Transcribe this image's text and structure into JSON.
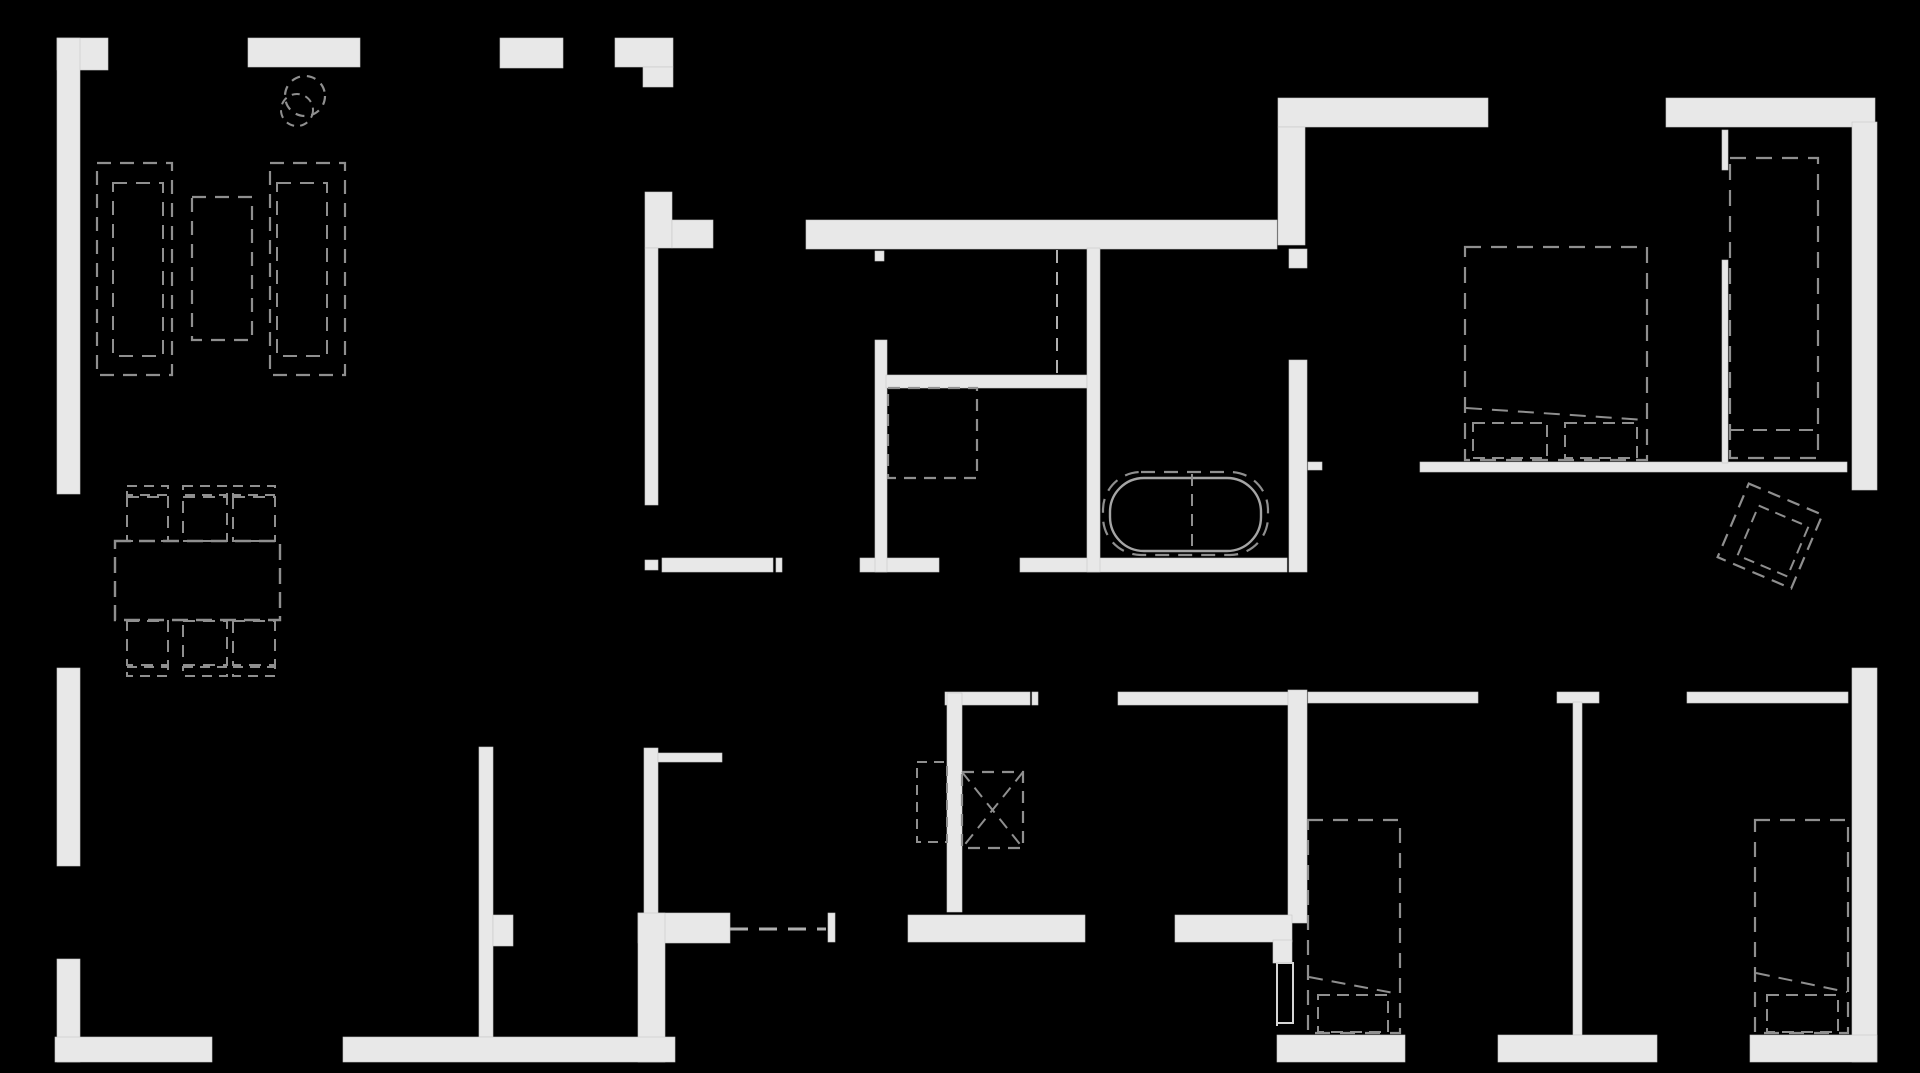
{
  "canvas": {
    "width": 1920,
    "height": 1073,
    "background": "#000000"
  },
  "palette": {
    "wall_fill": "#e8e8e8",
    "wall_edge": "#c6c6c6",
    "furniture_stroke": "#8f8f8f",
    "fixture_stroke": "#a5a5a5",
    "door_stroke": "#b0b0b0",
    "leaf_stroke": "#d6d6d6"
  },
  "walls": [
    {
      "n": "wall-top-left-corner-arm",
      "x": 57,
      "y": 38,
      "w": 51,
      "h": 32
    },
    {
      "n": "wall-left-upper",
      "x": 57,
      "y": 38,
      "w": 23,
      "h": 456
    },
    {
      "n": "wall-left-middle",
      "x": 57,
      "y": 668,
      "w": 23,
      "h": 198
    },
    {
      "n": "wall-left-lower",
      "x": 57,
      "y": 959,
      "w": 23,
      "h": 103
    },
    {
      "n": "wall-bottom-left-corner-arm",
      "x": 55,
      "y": 1037,
      "w": 157,
      "h": 25
    },
    {
      "n": "wall-top-a",
      "x": 248,
      "y": 38,
      "w": 112,
      "h": 29
    },
    {
      "n": "wall-top-b",
      "x": 500,
      "y": 38,
      "w": 63,
      "h": 30
    },
    {
      "n": "wall-top-c",
      "x": 615,
      "y": 38,
      "w": 58,
      "h": 29
    },
    {
      "n": "wall-top-c-step",
      "x": 643,
      "y": 67,
      "w": 30,
      "h": 20
    },
    {
      "n": "wall-corridor-upper-l",
      "x": 645,
      "y": 192,
      "w": 27,
      "h": 56
    },
    {
      "n": "wall-corridor-upper-arm",
      "x": 672,
      "y": 220,
      "w": 41,
      "h": 28
    },
    {
      "n": "wall-corridor-left-upper",
      "x": 645,
      "y": 248,
      "w": 13,
      "h": 257
    },
    {
      "n": "wall-corridor-stub",
      "x": 645,
      "y": 560,
      "w": 13,
      "h": 10
    },
    {
      "n": "wall-mid-bottom-a",
      "x": 662,
      "y": 558,
      "w": 111,
      "h": 14
    },
    {
      "n": "door-tick-mid-a",
      "x": 776,
      "y": 558,
      "w": 6,
      "h": 14
    },
    {
      "n": "wall-mid-bottom-b",
      "x": 860,
      "y": 558,
      "w": 79,
      "h": 14
    },
    {
      "n": "wall-mid-bottom-c",
      "x": 1020,
      "y": 558,
      "w": 267,
      "h": 14
    },
    {
      "n": "wall-mid-top",
      "x": 806,
      "y": 220,
      "w": 471,
      "h": 29
    },
    {
      "n": "door-tick-wc",
      "x": 875,
      "y": 251,
      "w": 9,
      "h": 10
    },
    {
      "n": "wall-wc-left",
      "x": 875,
      "y": 340,
      "w": 12,
      "h": 232
    },
    {
      "n": "wall-bath-divider",
      "x": 886,
      "y": 375,
      "w": 201,
      "h": 13
    },
    {
      "n": "wall-bath-right",
      "x": 1087,
      "y": 248,
      "w": 13,
      "h": 324
    },
    {
      "n": "wall-topright-a",
      "x": 1278,
      "y": 98,
      "w": 210,
      "h": 29
    },
    {
      "n": "wall-topright-b",
      "x": 1666,
      "y": 98,
      "w": 209,
      "h": 29
    },
    {
      "n": "wall-topright-arm",
      "x": 1278,
      "y": 127,
      "w": 27,
      "h": 118
    },
    {
      "n": "wall-right-upper",
      "x": 1852,
      "y": 122,
      "w": 25,
      "h": 368
    },
    {
      "n": "wall-right-lower",
      "x": 1852,
      "y": 668,
      "w": 25,
      "h": 394
    },
    {
      "n": "wall-stub-upper",
      "x": 1289,
      "y": 249,
      "w": 18,
      "h": 19
    },
    {
      "n": "wall-bath2-right",
      "x": 1289,
      "y": 360,
      "w": 18,
      "h": 212
    },
    {
      "n": "door-tick-bed1",
      "x": 1308,
      "y": 462,
      "w": 14,
      "h": 8
    },
    {
      "n": "wall-bed1-bottom",
      "x": 1420,
      "y": 462,
      "w": 427,
      "h": 10
    },
    {
      "n": "wall-row2-a",
      "x": 945,
      "y": 692,
      "w": 85,
      "h": 13
    },
    {
      "n": "door-tick-row2",
      "x": 1032,
      "y": 692,
      "w": 6,
      "h": 13
    },
    {
      "n": "wall-row2-b",
      "x": 1118,
      "y": 692,
      "w": 170,
      "h": 13
    },
    {
      "n": "wall-center-vert",
      "x": 1288,
      "y": 690,
      "w": 19,
      "h": 233
    },
    {
      "n": "wall-row2-c",
      "x": 1308,
      "y": 692,
      "w": 170,
      "h": 11
    },
    {
      "n": "wall-row2-t",
      "x": 1557,
      "y": 692,
      "w": 42,
      "h": 11
    },
    {
      "n": "wall-thin-bedrooms",
      "x": 1573,
      "y": 702,
      "w": 9,
      "h": 333
    },
    {
      "n": "wall-row2-d",
      "x": 1687,
      "y": 692,
      "w": 161,
      "h": 11
    },
    {
      "n": "wall-thin-top-a",
      "x": 1722,
      "y": 130,
      "w": 6,
      "h": 40
    },
    {
      "n": "wall-thin-top-b",
      "x": 1722,
      "y": 260,
      "w": 6,
      "h": 203
    },
    {
      "n": "wall-row3-a",
      "x": 908,
      "y": 915,
      "w": 177,
      "h": 27
    },
    {
      "n": "wall-row3-b",
      "x": 1175,
      "y": 915,
      "w": 117,
      "h": 27
    },
    {
      "n": "wall-entry-arm",
      "x": 638,
      "y": 913,
      "w": 92,
      "h": 30
    },
    {
      "n": "door-tick-entry",
      "x": 828,
      "y": 913,
      "w": 7,
      "h": 29
    },
    {
      "n": "wall-corridor-left-lower",
      "x": 644,
      "y": 748,
      "w": 14,
      "h": 174
    },
    {
      "n": "wall-entry-left-vert",
      "x": 638,
      "y": 913,
      "w": 27,
      "h": 149
    },
    {
      "n": "wall-thin-counter",
      "x": 658,
      "y": 753,
      "w": 64,
      "h": 9
    },
    {
      "n": "wall-pantry-left",
      "x": 479,
      "y": 747,
      "w": 14,
      "h": 290
    },
    {
      "n": "wall-pantry-stub",
      "x": 493,
      "y": 915,
      "w": 20,
      "h": 31
    },
    {
      "n": "wall-bottom-a",
      "x": 343,
      "y": 1037,
      "w": 332,
      "h": 25
    },
    {
      "n": "wall-bottom-b",
      "x": 1277,
      "y": 1035,
      "w": 128,
      "h": 27
    },
    {
      "n": "wall-bottom-c",
      "x": 1498,
      "y": 1035,
      "w": 159,
      "h": 27
    },
    {
      "n": "wall-bottom-d",
      "x": 1750,
      "y": 1035,
      "w": 127,
      "h": 27
    },
    {
      "n": "wall-doorpost",
      "x": 1273,
      "y": 940,
      "w": 19,
      "h": 23
    },
    {
      "n": "wall-laundry-vert",
      "x": 947,
      "y": 693,
      "w": 15,
      "h": 219
    }
  ],
  "furniture": [
    {
      "n": "plant-pot-outer",
      "k": "circle",
      "cx": 305,
      "cy": 96,
      "r": 20,
      "dash": "9 7",
      "sw": 2.2
    },
    {
      "n": "plant-pot-inner",
      "k": "circle",
      "cx": 297,
      "cy": 110,
      "r": 16,
      "dash": "8 6",
      "sw": 2
    },
    {
      "n": "sofa-left-outer",
      "k": "drect",
      "x": 97,
      "y": 163,
      "w": 75,
      "h": 212,
      "dash": "14 9",
      "sw": 2.2
    },
    {
      "n": "sofa-left-inner",
      "k": "drect",
      "x": 113,
      "y": 183,
      "w": 50,
      "h": 173,
      "dash": "14 9",
      "sw": 2
    },
    {
      "n": "coffee-table",
      "k": "drect",
      "x": 192,
      "y": 197,
      "w": 60,
      "h": 143,
      "dash": "14 9",
      "sw": 2.2
    },
    {
      "n": "sofa-right-outer",
      "k": "drect",
      "x": 270,
      "y": 163,
      "w": 75,
      "h": 212,
      "dash": "14 9",
      "sw": 2.2
    },
    {
      "n": "sofa-right-inner",
      "k": "drect",
      "x": 277,
      "y": 183,
      "w": 50,
      "h": 173,
      "dash": "14 9",
      "sw": 2
    },
    {
      "n": "dining-table",
      "k": "drect",
      "x": 115,
      "y": 541,
      "w": 165,
      "h": 79,
      "dash": "16 8",
      "sw": 2.4
    },
    {
      "n": "chair-top-1-back",
      "k": "drect",
      "x": 127,
      "y": 486,
      "w": 41,
      "h": 9,
      "dash": "10 7",
      "sw": 2
    },
    {
      "n": "chair-top-1-seat",
      "k": "drect",
      "x": 127,
      "y": 497,
      "w": 41,
      "h": 44,
      "dash": "12 8",
      "sw": 2
    },
    {
      "n": "chair-top-2-back",
      "k": "drect",
      "x": 183,
      "y": 486,
      "w": 44,
      "h": 9,
      "dash": "10 7",
      "sw": 2
    },
    {
      "n": "chair-top-2-seat",
      "k": "drect",
      "x": 183,
      "y": 497,
      "w": 44,
      "h": 44,
      "dash": "12 8",
      "sw": 2
    },
    {
      "n": "chair-top-3-back",
      "k": "drect",
      "x": 233,
      "y": 486,
      "w": 42,
      "h": 9,
      "dash": "10 7",
      "sw": 2
    },
    {
      "n": "chair-top-3-seat",
      "k": "drect",
      "x": 233,
      "y": 497,
      "w": 42,
      "h": 44,
      "dash": "12 8",
      "sw": 2
    },
    {
      "n": "chair-bottom-1-seat",
      "k": "drect",
      "x": 127,
      "y": 621,
      "w": 41,
      "h": 44,
      "dash": "12 8",
      "sw": 2
    },
    {
      "n": "chair-bottom-1-back",
      "k": "drect",
      "x": 127,
      "y": 667,
      "w": 41,
      "h": 9,
      "dash": "10 7",
      "sw": 2
    },
    {
      "n": "chair-bottom-2-seat",
      "k": "drect",
      "x": 183,
      "y": 621,
      "w": 44,
      "h": 44,
      "dash": "12 8",
      "sw": 2
    },
    {
      "n": "chair-bottom-2-back",
      "k": "drect",
      "x": 183,
      "y": 667,
      "w": 44,
      "h": 9,
      "dash": "10 7",
      "sw": 2
    },
    {
      "n": "chair-bottom-3-seat",
      "k": "drect",
      "x": 233,
      "y": 621,
      "w": 42,
      "h": 44,
      "dash": "12 8",
      "sw": 2
    },
    {
      "n": "chair-bottom-3-back",
      "k": "drect",
      "x": 233,
      "y": 667,
      "w": 42,
      "h": 9,
      "dash": "10 7",
      "sw": 2
    },
    {
      "n": "shower-enclosure",
      "k": "drect",
      "x": 888,
      "y": 388,
      "w": 89,
      "h": 90,
      "dash": "12 8",
      "sw": 2.2
    },
    {
      "n": "door-dash-wc",
      "k": "line",
      "x1": 1057,
      "y1": 250,
      "x2": 1057,
      "y2": 375,
      "dash": "13 9",
      "sw": 2,
      "c": "door_stroke"
    },
    {
      "n": "bathtub-outer",
      "k": "rrect",
      "x": 1103,
      "y": 472,
      "w": 165,
      "h": 83,
      "rx": 38,
      "style": "dash",
      "dash": "14 9",
      "sw": 2.2
    },
    {
      "n": "bathtub-inner",
      "k": "rrect",
      "x": 1110,
      "y": 478,
      "w": 151,
      "h": 73,
      "rx": 34,
      "style": "solid",
      "sw": 2.4,
      "c": "fixture_stroke"
    },
    {
      "n": "bathtub-divider",
      "k": "line",
      "x1": 1192,
      "y1": 474,
      "x2": 1192,
      "y2": 553,
      "dash": "12 8",
      "sw": 2
    },
    {
      "n": "bed-master",
      "k": "drect",
      "x": 1465,
      "y": 247,
      "w": 182,
      "h": 213,
      "dash": "16 10",
      "sw": 2.2
    },
    {
      "n": "bed-master-fold",
      "k": "line",
      "x1": 1466,
      "y1": 408,
      "x2": 1646,
      "y2": 420,
      "dash": "16 10",
      "sw": 2
    },
    {
      "n": "pillow-master-1",
      "k": "drect",
      "x": 1473,
      "y": 423,
      "w": 74,
      "h": 35,
      "dash": "12 7",
      "sw": 2
    },
    {
      "n": "pillow-master-2",
      "k": "drect",
      "x": 1565,
      "y": 423,
      "w": 72,
      "h": 35,
      "dash": "12 7",
      "sw": 2
    },
    {
      "n": "wardrobe-master",
      "k": "drect",
      "x": 1730,
      "y": 158,
      "w": 88,
      "h": 300,
      "dash": "16 10",
      "sw": 2.2
    },
    {
      "n": "wardrobe-master-shelf",
      "k": "line",
      "x1": 1730,
      "y1": 430,
      "x2": 1818,
      "y2": 430,
      "dash": "14 9",
      "sw": 2
    },
    {
      "n": "armchair-outer",
      "k": "rot",
      "cx": 1770,
      "cy": 536,
      "s": 80,
      "a": 23,
      "dash": "13 8",
      "sw": 2.2
    },
    {
      "n": "armchair-inner",
      "k": "rot",
      "cx": 1773,
      "cy": 541,
      "s": 54,
      "a": 23,
      "dash": "11 7",
      "sw": 2
    },
    {
      "n": "hall-closet",
      "k": "drect",
      "x": 917,
      "y": 762,
      "w": 30,
      "h": 80,
      "dash": "10 7",
      "sw": 2
    },
    {
      "n": "shaft-box",
      "k": "drect",
      "x": 962,
      "y": 772,
      "w": 61,
      "h": 76,
      "dash": "12 8",
      "sw": 2.2
    },
    {
      "n": "shaft-diagonal-1",
      "k": "line",
      "x1": 962,
      "y1": 772,
      "x2": 1023,
      "y2": 848,
      "dash": "12 8",
      "sw": 2
    },
    {
      "n": "shaft-diagonal-2",
      "k": "line",
      "x1": 1023,
      "y1": 772,
      "x2": 962,
      "y2": 848,
      "dash": "12 8",
      "sw": 2
    },
    {
      "n": "door-dash-entry",
      "k": "line",
      "x1": 730,
      "y1": 929,
      "x2": 826,
      "y2": 929,
      "dash": "18 11",
      "sw": 3,
      "c": "door_stroke"
    },
    {
      "n": "bed-2",
      "k": "drect",
      "x": 1308,
      "y": 820,
      "w": 92,
      "h": 213,
      "dash": "15 10",
      "sw": 2.2
    },
    {
      "n": "bed-2-fold",
      "k": "line",
      "x1": 1309,
      "y1": 977,
      "x2": 1399,
      "y2": 994,
      "dash": "14 9",
      "sw": 2
    },
    {
      "n": "pillow-2",
      "k": "drect",
      "x": 1318,
      "y": 995,
      "w": 70,
      "h": 37,
      "dash": "12 7",
      "sw": 2
    },
    {
      "n": "bed-3",
      "k": "drect",
      "x": 1755,
      "y": 820,
      "w": 93,
      "h": 213,
      "dash": "15 10",
      "sw": 2.2
    },
    {
      "n": "bed-3-fold",
      "k": "line",
      "x1": 1756,
      "y1": 973,
      "x2": 1847,
      "y2": 992,
      "dash": "14 9",
      "sw": 2
    },
    {
      "n": "pillow-3",
      "k": "drect",
      "x": 1767,
      "y": 995,
      "w": 71,
      "h": 37,
      "dash": "12 7",
      "sw": 2
    },
    {
      "n": "door-leaf",
      "k": "orect",
      "x": 1277,
      "y": 963,
      "w": 16,
      "h": 60,
      "sw": 2,
      "c": "leaf_stroke"
    },
    {
      "n": "door-leaf-dash",
      "k": "line",
      "x1": 1277,
      "y1": 965,
      "x2": 1277,
      "y2": 1030,
      "dash": "10 7",
      "sw": 2,
      "c": "leaf_stroke"
    }
  ]
}
